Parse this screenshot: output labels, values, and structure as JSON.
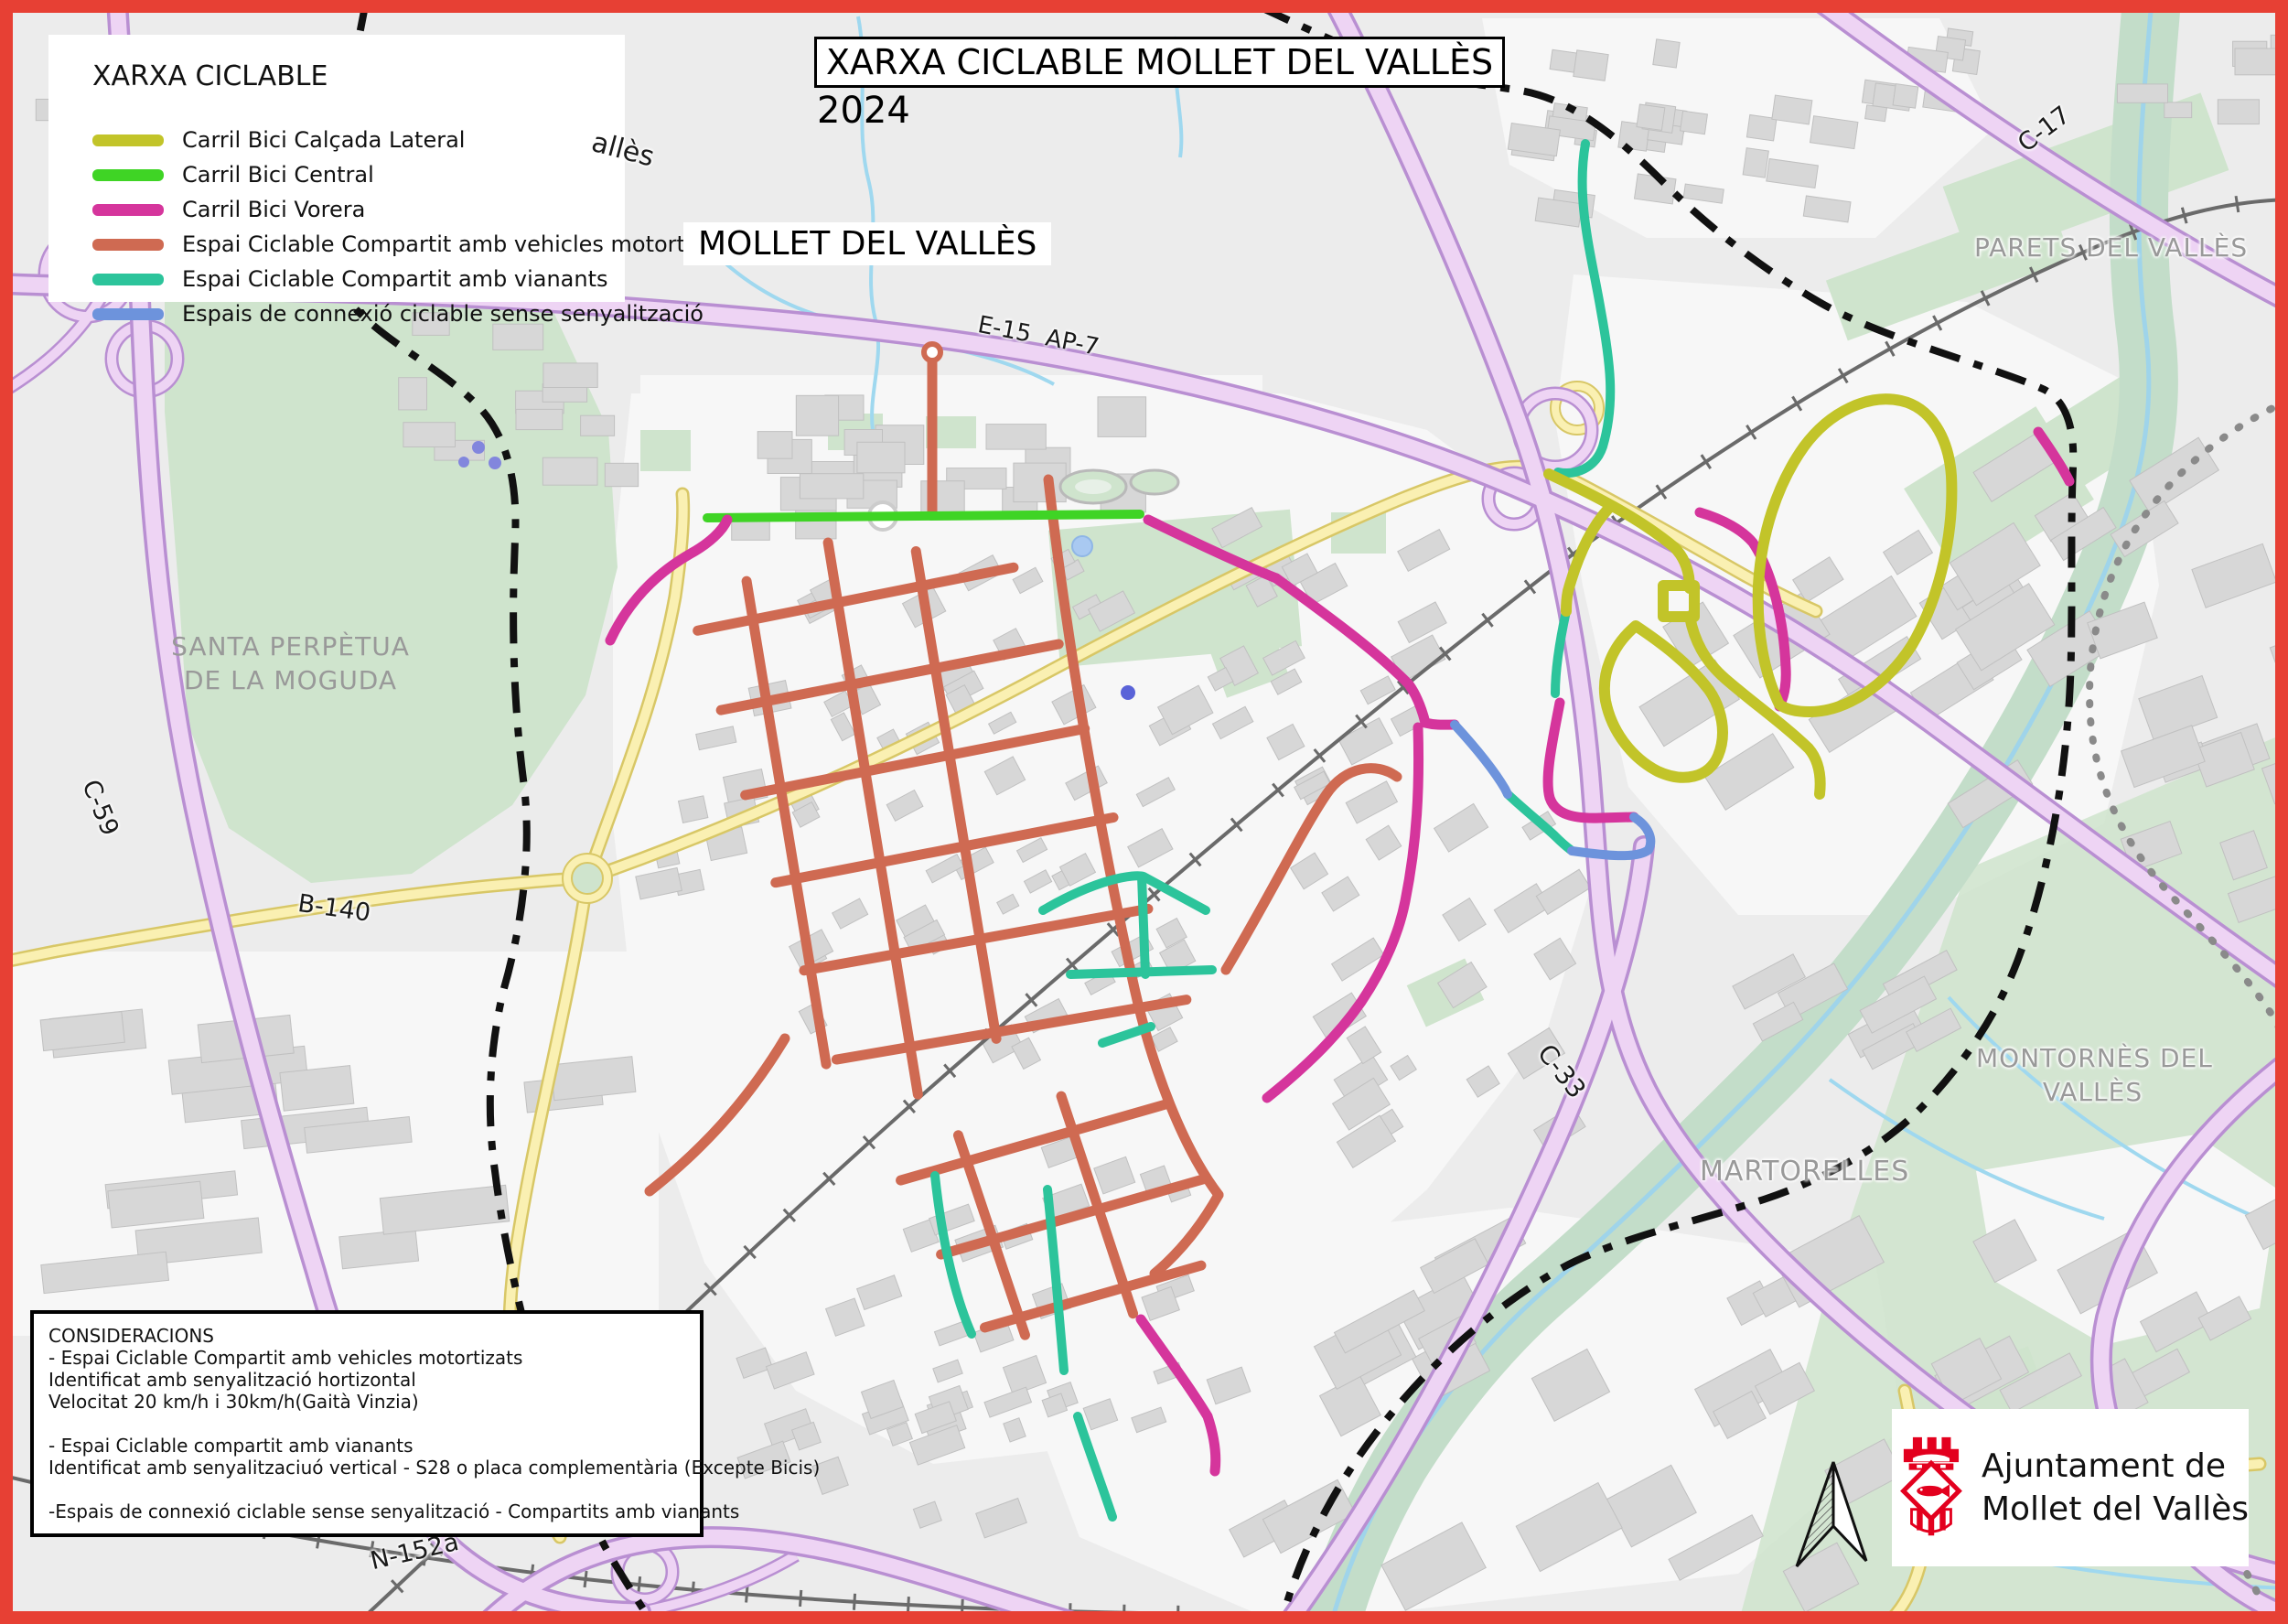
{
  "frame": {
    "border_color": "#e74034"
  },
  "legend": {
    "title": "XARXA CICLABLE",
    "items": [
      {
        "label": "Carril Bici Calçada Lateral",
        "color": "#c2c429"
      },
      {
        "label": "Carril Bici Central",
        "color": "#3fd425"
      },
      {
        "label": "Carril Bici Vorera",
        "color": "#d5359c"
      },
      {
        "label": "Espai Ciclable Compartit amb vehicles motortizats",
        "color": "#cf6a52"
      },
      {
        "label": "Espai Ciclable Compartit amb vianants",
        "color": "#2cc49b"
      },
      {
        "label": "Espais de connexió ciclable sense senyalització",
        "color": "#6d93dc"
      }
    ]
  },
  "title_box": {
    "title": "XARXA CICLABLE MOLLET DEL VALLÈS",
    "year": "2024"
  },
  "map_labels": {
    "city": "MOLLET DEL VALLÈS",
    "santa_perpetua": [
      "SANTA PERPÈTUA",
      "DE LA MOGUDA"
    ],
    "parets": "PARETS DEL VALLÈS",
    "montornes": [
      "MONTORNÈS DEL",
      "VALLÈS"
    ],
    "martorelles": "MARTORELLES",
    "valles_partial": "allès",
    "roads": {
      "c17": "C-17",
      "e15": "E-15  AP-7",
      "c59": "C-59",
      "b140": "B-140",
      "c33": "C-33",
      "n152a": "N-152a"
    }
  },
  "consideracions": {
    "title": "CONSIDERACIONS",
    "lines": [
      "- Espai Ciclable Compartit amb vehicles motortizats",
      "Identificat amb senyalització hortizontal",
      "Velocitat 20 km/h i 30km/h(Gaità Vinzia)",
      "",
      "- Espai Ciclable compartit amb vianants",
      "Identificat amb senyalitzaciuó  vertical - S28 o placa complementària (Excepte Bicis)",
      "",
      "-Espais de connexió ciclable sense senyalització - Compartits amb vianants"
    ]
  },
  "footer_logo": {
    "line1": "Ajuntament de",
    "line2": "Mollet del Vallès",
    "crest_color": "#e3001e"
  }
}
